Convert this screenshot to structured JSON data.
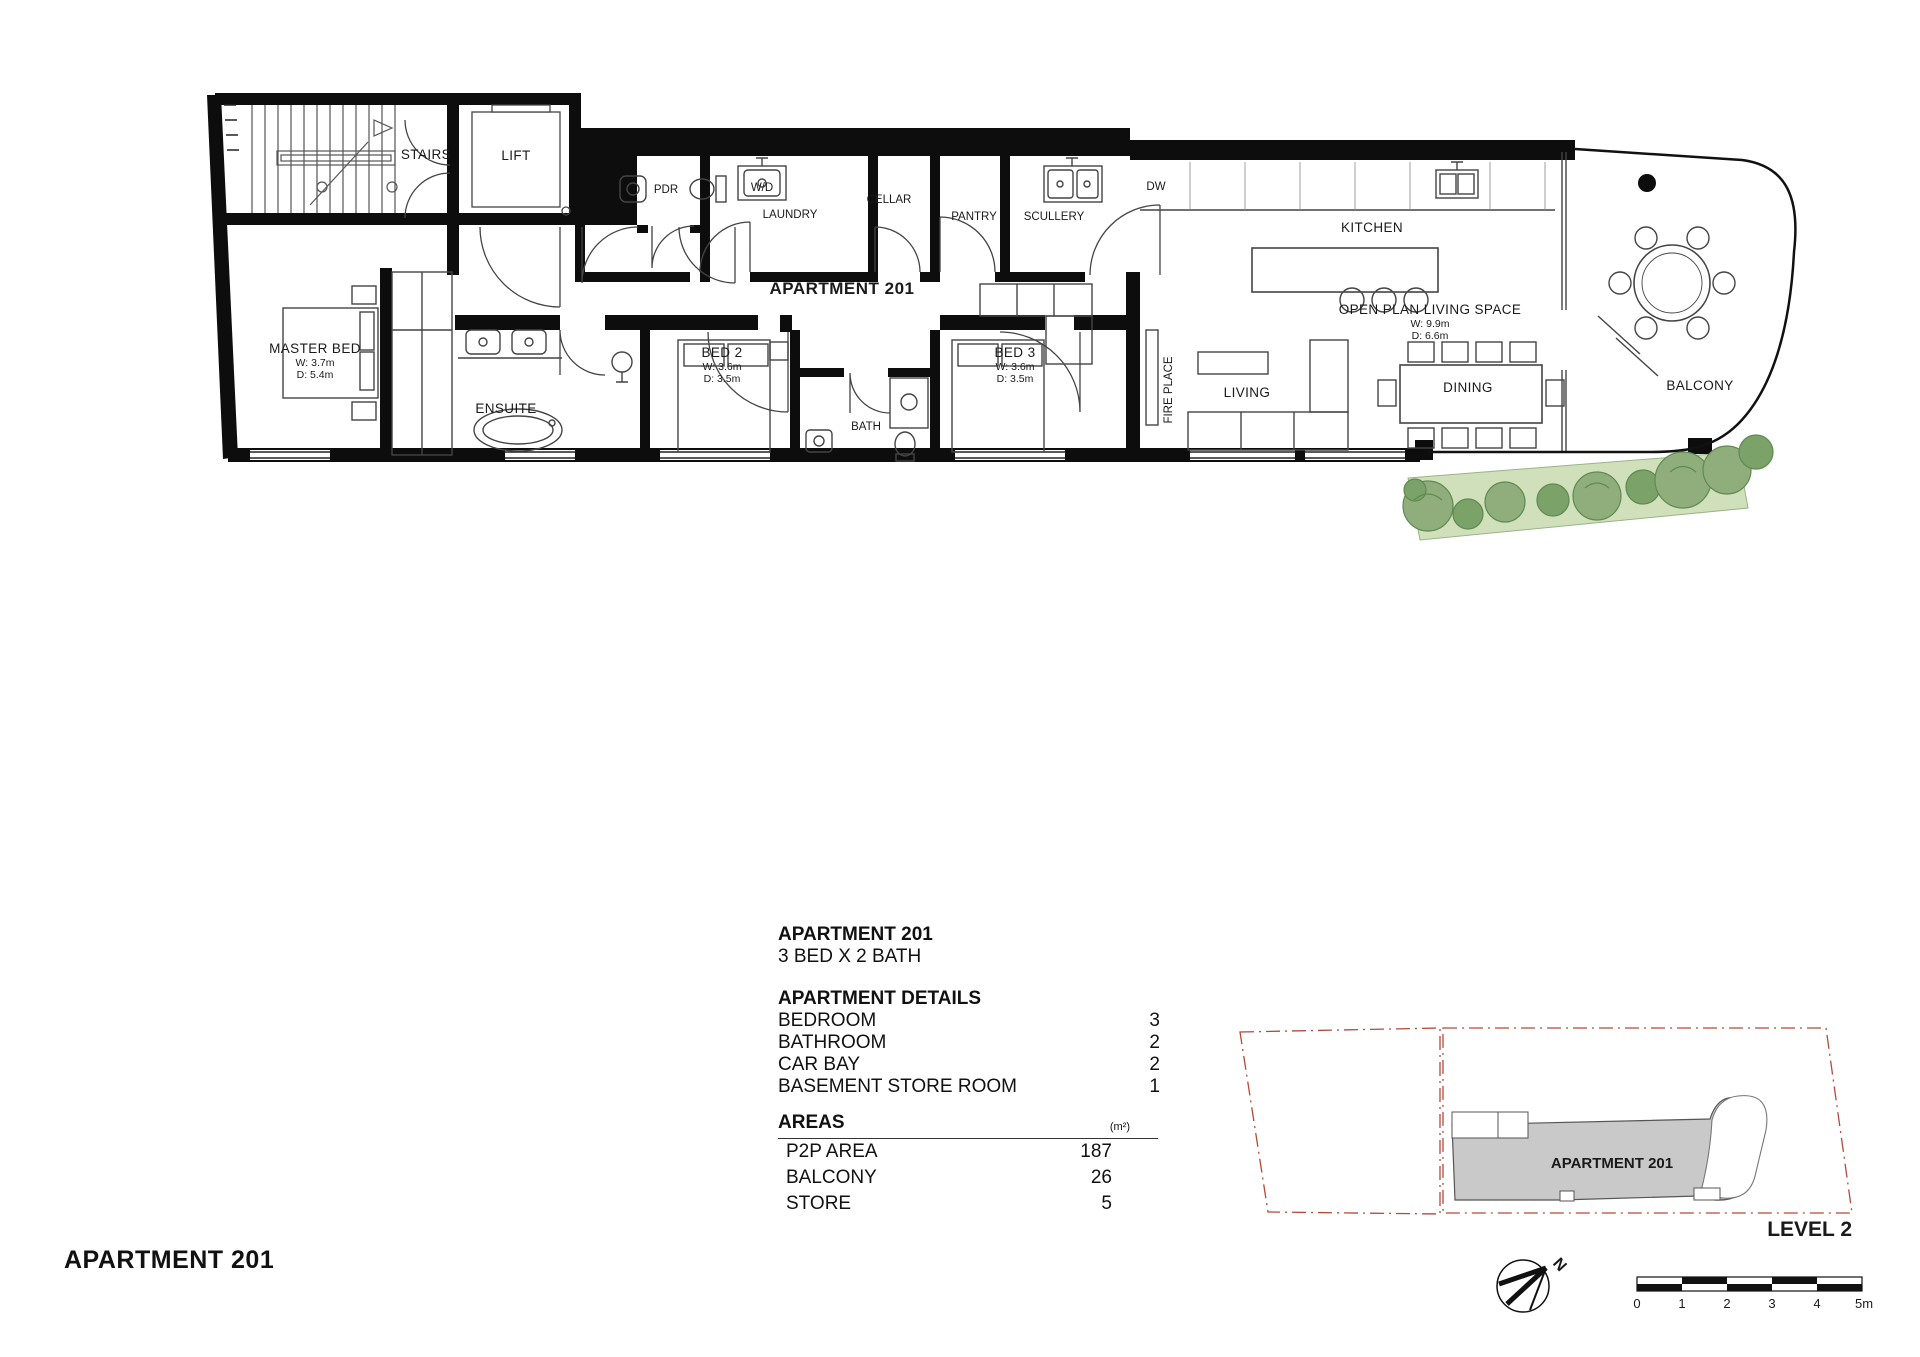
{
  "plan": {
    "apartment_label": "APARTMENT 201",
    "stairs": "STAIRS",
    "lift": "LIFT",
    "pdr": "PDR",
    "wd": "W/D",
    "laundry": "LAUNDRY",
    "cellar": "CELLAR",
    "pantry": "PANTRY",
    "scullery": "SCULLERY",
    "dw": "DW",
    "kitchen": "KITCHEN",
    "open_plan": "OPEN PLAN LIVING SPACE",
    "open_plan_w": "W: 9.9m",
    "open_plan_d": "D: 6.6m",
    "master_bed": "MASTER BED",
    "master_w": "W: 3.7m",
    "master_d": "D: 5.4m",
    "ensuite": "ENSUITE",
    "bed2": "BED 2",
    "bed2_w": "W: 3.6m",
    "bed2_d": "D: 3.5m",
    "bath": "BATH",
    "bed3": "BED 3",
    "bed3_w": "W: 3.6m",
    "bed3_d": "D: 3.5m",
    "fireplace": "FIRE PLACE",
    "living": "LIVING",
    "dining": "DINING",
    "balcony": "BALCONY"
  },
  "details": {
    "title": "APARTMENT 201",
    "subtitle": "3 BED X 2 BATH",
    "details_heading": "APARTMENT DETAILS",
    "rows": [
      {
        "label": "BEDROOM",
        "value": "3"
      },
      {
        "label": "BATHROOM",
        "value": "2"
      },
      {
        "label": "CAR BAY",
        "value": "2"
      },
      {
        "label": "BASEMENT STORE ROOM",
        "value": "1"
      }
    ],
    "areas_heading": "AREAS",
    "areas_unit": "(m²)",
    "areas_rows": [
      {
        "label": "P2P AREA",
        "value": "187"
      },
      {
        "label": "BALCONY",
        "value": "26"
      },
      {
        "label": "STORE",
        "value": "5"
      }
    ]
  },
  "key_plan": {
    "apartment_label": "APARTMENT 201",
    "level_label": "LEVEL 2"
  },
  "north_label": "N",
  "scale_bar": {
    "ticks": [
      "0",
      "1",
      "2",
      "3",
      "4",
      "5m"
    ]
  },
  "footer_title": "APARTMENT 201",
  "colors": {
    "garden_light": "#cfe0ba",
    "plant_green": "#8fae7c",
    "plant_dark": "#5f8a52",
    "keyplan_grey": "#c9c9c9",
    "boundary_dash": "#b24a3a"
  }
}
